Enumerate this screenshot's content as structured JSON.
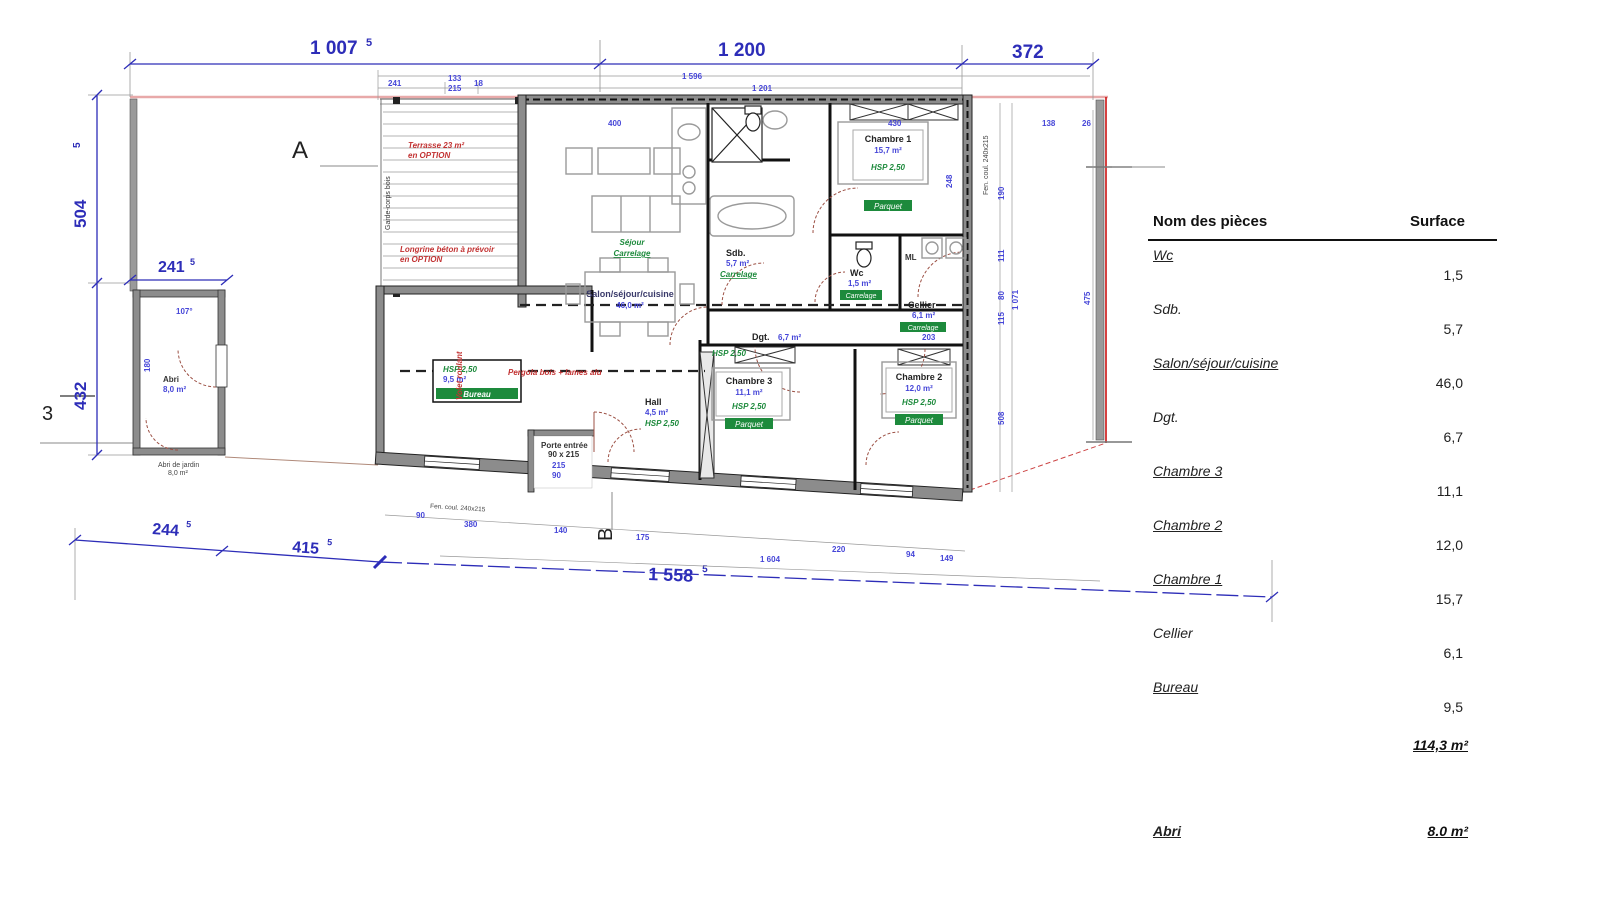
{
  "table": {
    "col_name": "Nom des pièces",
    "col_surface": "Surface",
    "rows": [
      {
        "name": "Wc",
        "value": "1,5",
        "underline": true
      },
      {
        "name": "Sdb.",
        "value": "5,7",
        "underline": false
      },
      {
        "name": "Salon/séjour/cuisine",
        "value": "46,0",
        "underline": true
      },
      {
        "name": "Dgt.",
        "value": "6,7",
        "underline": false
      },
      {
        "name": "Chambre 3",
        "value": "11,1",
        "underline": true
      },
      {
        "name": "Chambre 2",
        "value": "12,0",
        "underline": true
      },
      {
        "name": "Chambre 1",
        "value": "15,7",
        "underline": true
      },
      {
        "name": "Cellier",
        "value": "6,1",
        "underline": false
      },
      {
        "name": "Bureau",
        "value": "9,5",
        "underline": true
      }
    ],
    "total": "114,3 m²",
    "abri_label": "Abri",
    "abri_value": "8.0 m²"
  },
  "plan": {
    "markers": {
      "a": "A",
      "three": "3",
      "b": "B"
    },
    "dims": {
      "top": [
        {
          "m": "1 007",
          "s": "5"
        },
        {
          "m": "1 200",
          "s": ""
        },
        {
          "m": "372",
          "s": ""
        }
      ],
      "left": [
        {
          "m": "504",
          "s": "5"
        },
        {
          "m": "432",
          "s": ""
        }
      ],
      "left2": {
        "m": "241",
        "s": "5"
      },
      "bottom": [
        {
          "m": "244",
          "s": "5"
        },
        {
          "m": "415",
          "s": "5"
        },
        {
          "m": "1 558",
          "s": "5"
        }
      ]
    },
    "micro": [
      "241",
      "133",
      "215",
      "18",
      "1 596",
      "1 201",
      "400",
      "430",
      "248",
      "26",
      "190",
      "111",
      "80",
      "115",
      "508",
      "1 071",
      "475",
      "138",
      "90",
      "380",
      "140",
      "175",
      "220",
      "94",
      "149",
      "1 604",
      "107°",
      "180",
      "215",
      "90",
      "203"
    ],
    "rooms": [
      {
        "name": "Chambre 1",
        "area": "15,7 m²",
        "hsp": "HSP 2,50",
        "floor": "Parquet"
      },
      {
        "name": "Chambre 2",
        "area": "12,0 m²",
        "hsp": "HSP 2,50",
        "floor": "Parquet"
      },
      {
        "name": "Chambre 3",
        "area": "11,1 m²",
        "hsp": "HSP 2,50",
        "floor": "Parquet"
      },
      {
        "name": "Sdb.",
        "area": "5,7 m²",
        "floor": "Carrelage"
      },
      {
        "name": "Wc",
        "area": "1,5 m²",
        "floor": "Carrelage"
      },
      {
        "name": "Cellier",
        "area": "6,1 m²",
        "floor": "Carrelage"
      },
      {
        "name": "Dgt.",
        "area": "6,7 m²",
        "hsp": "HSP 2,50"
      },
      {
        "name": "Bureau",
        "area": "9,5 m²",
        "hsp": "HSP 2,50"
      },
      {
        "name": "Hall",
        "area": "4,5 m²",
        "hsp": "HSP 2,50"
      },
      {
        "name": "Séjour",
        "floor": "Carrelage"
      },
      {
        "name": "Salon/séjour/cuisine",
        "area": "46,0 m²"
      },
      {
        "name": "Abri",
        "area": "8,0 m²"
      }
    ],
    "annotations": {
      "terrace1a": "Terrasse 23 m²",
      "terrace1b": "en OPTION",
      "terrace2a": "Longrine béton à prévoir",
      "terrace2b": "en OPTION",
      "pergola": "Pergola bois + lames alu",
      "volet": "Volet roulant",
      "garde": "Garde-corps bois",
      "entry1": "Porte entrée",
      "entry2": "90 x 215",
      "ml": "ML",
      "window1": "Fen. coul. 240x215",
      "abri_cap1": "Abri de jardin",
      "abri_cap2": "8,0 m²"
    }
  }
}
